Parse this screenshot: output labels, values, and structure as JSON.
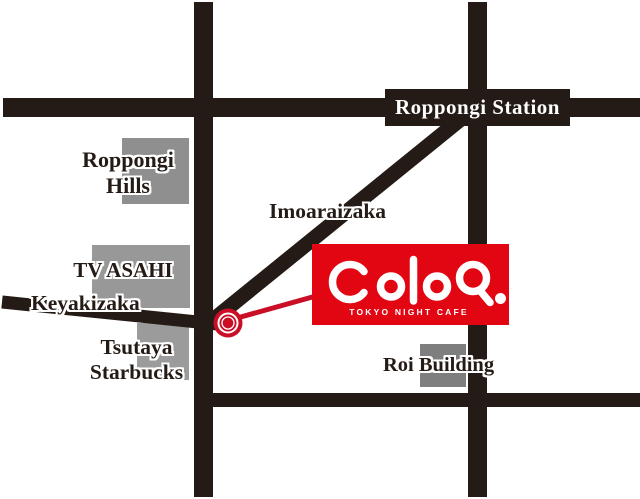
{
  "colors": {
    "road": "#251b16",
    "marker-red": "#c90e26",
    "logo-red": "#e20613",
    "gray-hills": "#8f8f8f",
    "gray-tv": "#989898",
    "gray-tsutaya": "#9b9b9b",
    "gray-roi": "#7e7e7e"
  },
  "labels": {
    "station": "Roppongi Station",
    "hills": [
      "Roppongi",
      "Hills"
    ],
    "imoaraizaka": "Imoaraizaka",
    "tv_asahi": "TV ASAHI",
    "keyakizaka": "Keyakizaka",
    "tsutaya_starbucks": [
      "Tsutaya",
      "Starbucks"
    ],
    "roi": "Roi Building"
  },
  "logo": {
    "name": "ColoR.",
    "tagline": "TOKYO NIGHT CAFE"
  }
}
